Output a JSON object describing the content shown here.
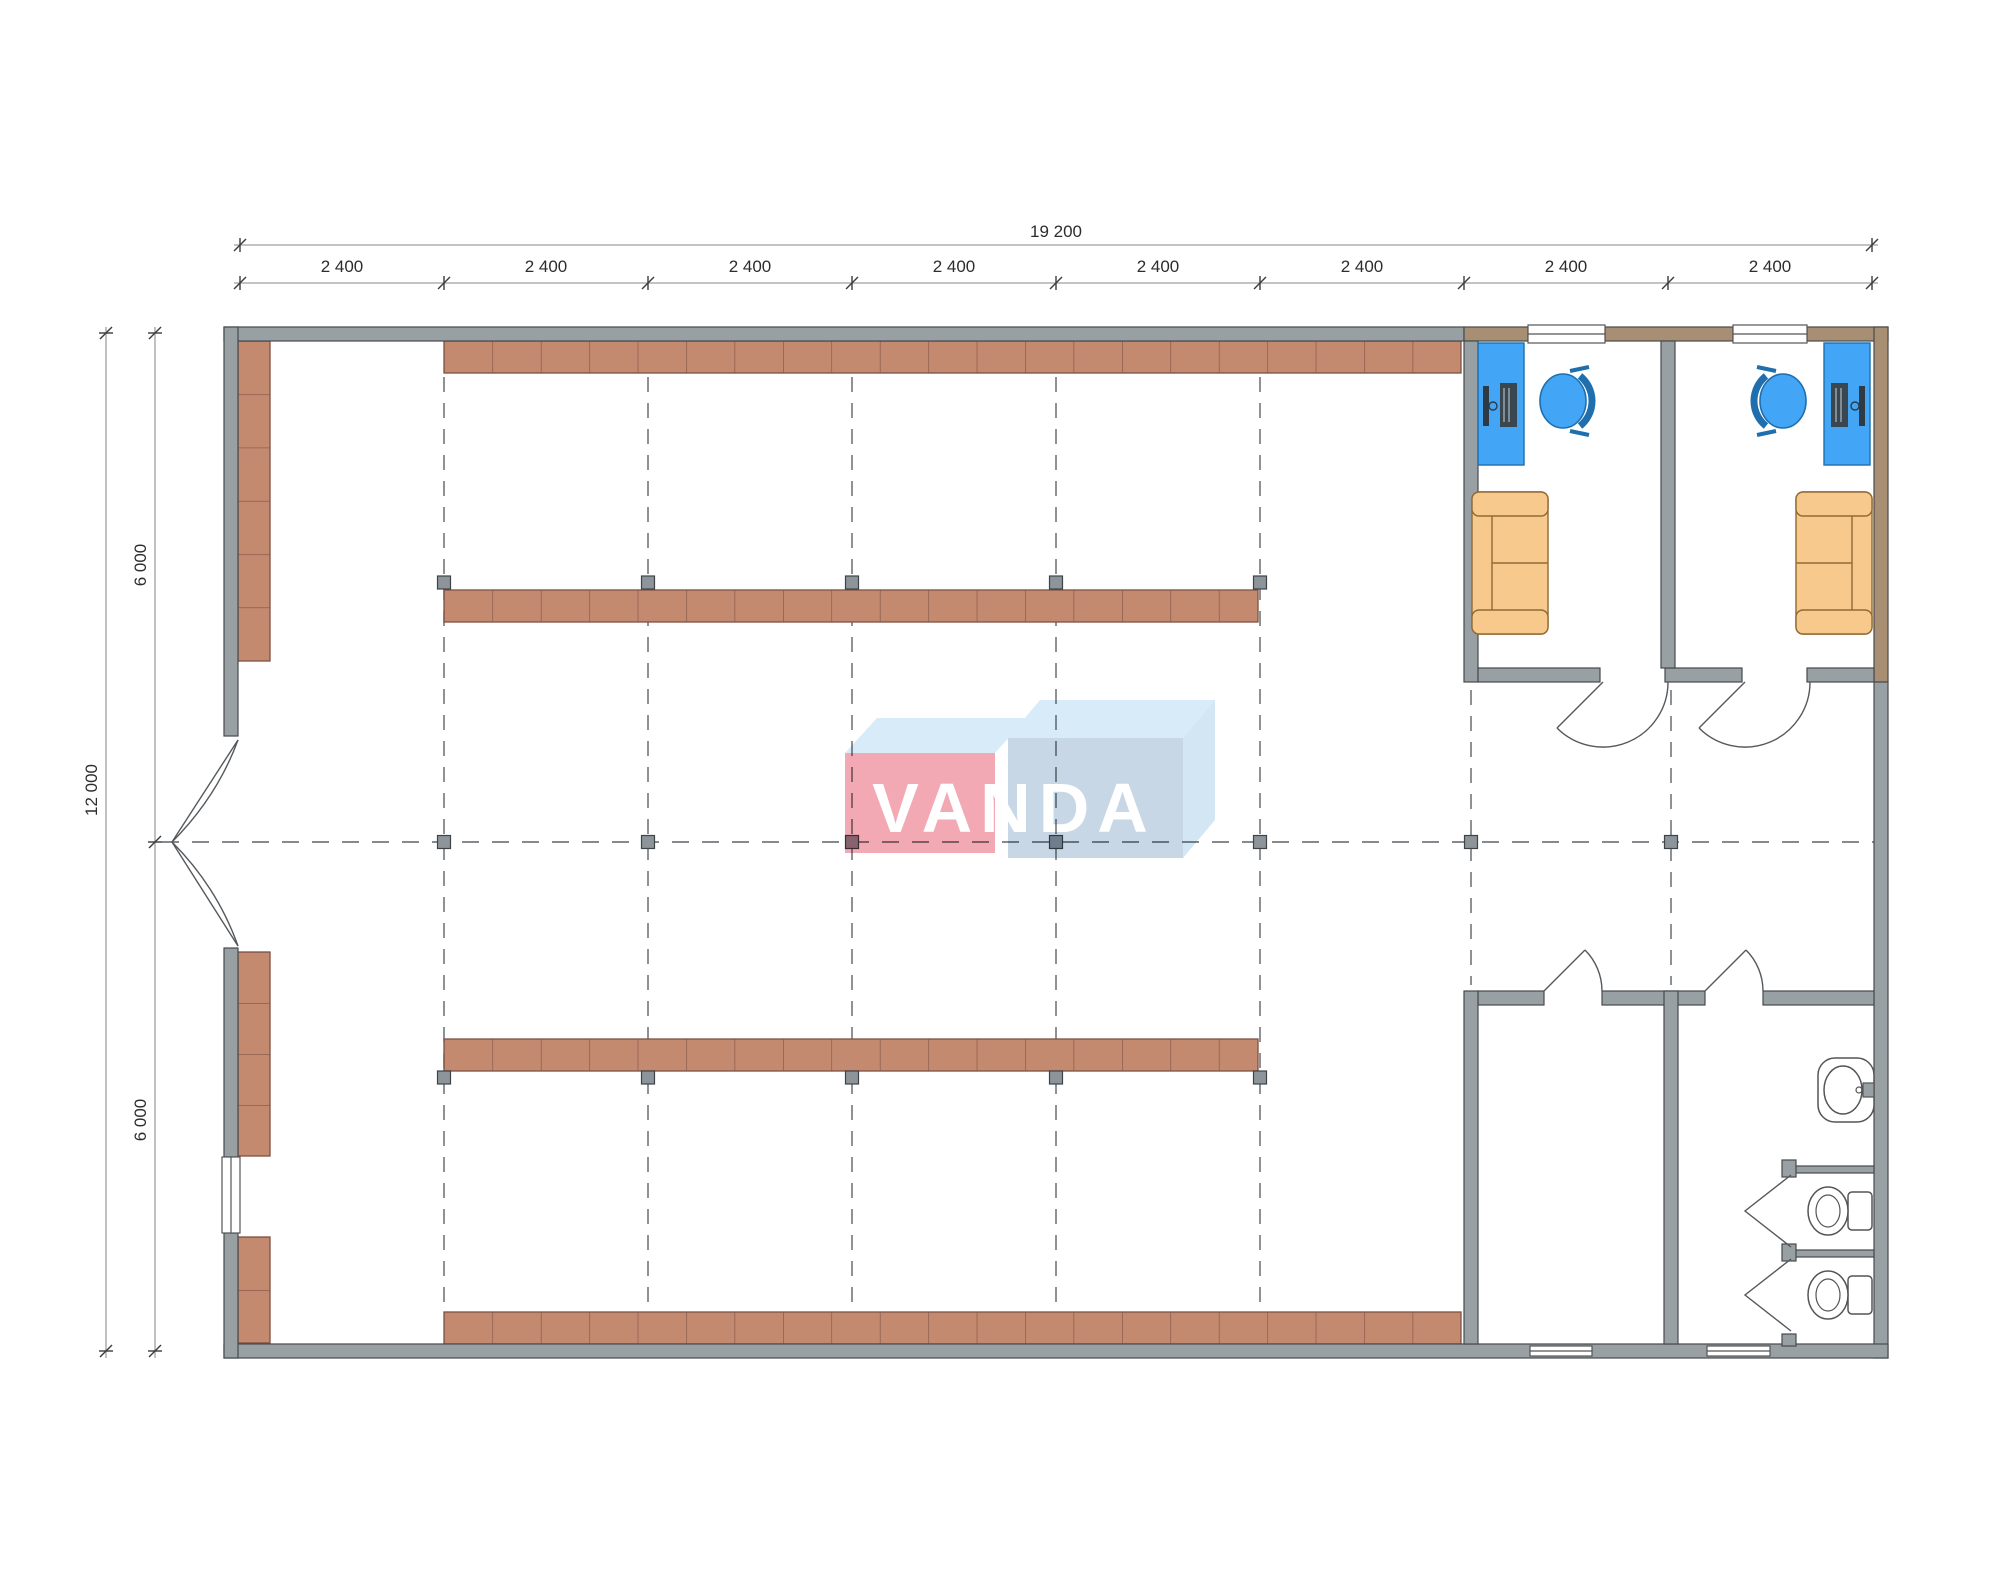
{
  "drawing": {
    "type": "architectural-floor-plan",
    "logo": {
      "text": "VANDA",
      "pink": "#f2a9b4",
      "blue": "#c7d7e6",
      "top_face": "#d7ecf8"
    },
    "dimensions": {
      "top_total": "19 200",
      "top_segments": [
        "2 400",
        "2 400",
        "2 400",
        "2 400",
        "2 400",
        "2 400",
        "2 400",
        "2 400"
      ],
      "left_total": "12 000",
      "left_upper": "6 000",
      "left_lower": "6 000"
    },
    "palette": {
      "wall": "#99a0a4",
      "wall_office": "#a88f73",
      "wall_stroke": "#454a4e",
      "shelf": "#c48a70",
      "shelf_stroke": "#7d5242",
      "desk": "#42a5f5",
      "chair": "#42a5f5",
      "sofa": "#f8c98c",
      "sofa_stroke": "#8f6a34",
      "column_marker": "#8d959b",
      "grid_dash": "#5f6468",
      "fixture_stroke": "#555555"
    },
    "symbols": [
      "shelf-rack",
      "column-marker",
      "grid-line",
      "double-entrance-door",
      "door-swing",
      "window",
      "office-desk",
      "computer",
      "office-chair",
      "sofa",
      "toilet",
      "sink",
      "toilet-stall"
    ]
  }
}
